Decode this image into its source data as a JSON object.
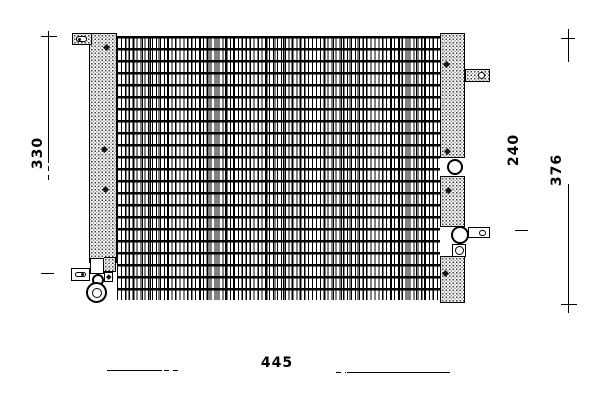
{
  "drawing": {
    "colors": {
      "ink": "#000000",
      "paper": "#ffffff"
    },
    "dimensions": {
      "d330": "330",
      "d240": "240",
      "d376": "376",
      "d445": "445"
    }
  }
}
